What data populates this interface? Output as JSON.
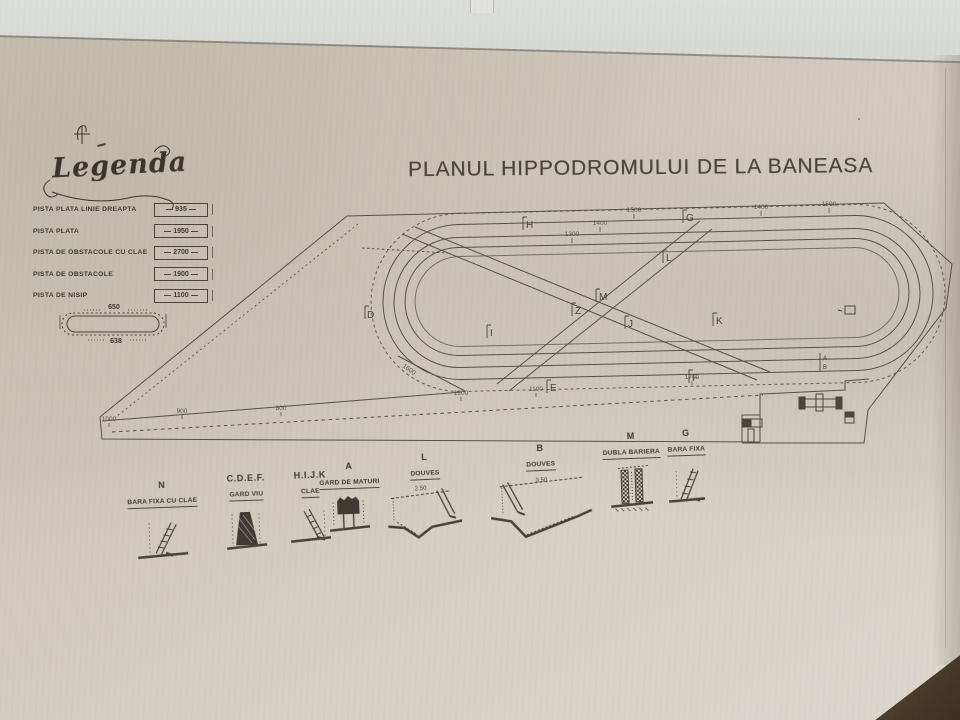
{
  "colors": {
    "paper": "#cfc9bb",
    "ink": "#46423a",
    "ink_faded": "#6a655a",
    "shelf_strip": "#d9dbd5",
    "desk_corner": "#42362a"
  },
  "title": "PLANUL HIPPODROMULUI DE LA BANEASA",
  "legend": {
    "heading": "Legenda",
    "items": [
      {
        "label": "PISTA PLATA LINIE DREAPTA",
        "value": "935"
      },
      {
        "label": "PISTA PLATA",
        "value": "1950"
      },
      {
        "label": "PISTA DE OBSTACOLE CU CLAE",
        "value": "2700"
      },
      {
        "label": "PISTA DE OBSTACOLE",
        "value": "1900"
      },
      {
        "label": "PISTA DE NISIP",
        "value": "1100"
      }
    ],
    "sample_oval": {
      "top": "650",
      "bottom": "638"
    }
  },
  "plan": {
    "markers": {
      "d": "D",
      "h": "H",
      "g": "G",
      "l": "L",
      "m": "M",
      "z": "Z",
      "i": "I",
      "j": "J",
      "k": "K",
      "e": "E",
      "f": "F",
      "a": "A",
      "b": "B"
    },
    "dims": {
      "d1": "1500",
      "d2": "1400",
      "d3": "1300",
      "d4": "1400",
      "d5": "1500",
      "d6": "1600",
      "d7": "1200",
      "d8": "1100",
      "d9": "1700",
      "d10": "1000",
      "d11": "900",
      "d12": "800"
    }
  },
  "details": [
    {
      "letter": "N",
      "name": "BARA FIXA CU CLAE"
    },
    {
      "letter": "C.D.E.F.",
      "name": "GARD VIU"
    },
    {
      "letter": "H.I.J.K",
      "name": "CLAE"
    },
    {
      "letter": "A",
      "name": "GARD DE MATURI"
    },
    {
      "letter": "L",
      "name": "DOUVES",
      "dim": "2.50"
    },
    {
      "letter": "B",
      "name": "DOUVES",
      "dim": "3.50"
    },
    {
      "letter": "M",
      "name": "DUBLA BARIERA"
    },
    {
      "letter": "G",
      "name": "BARA FIXA"
    }
  ]
}
